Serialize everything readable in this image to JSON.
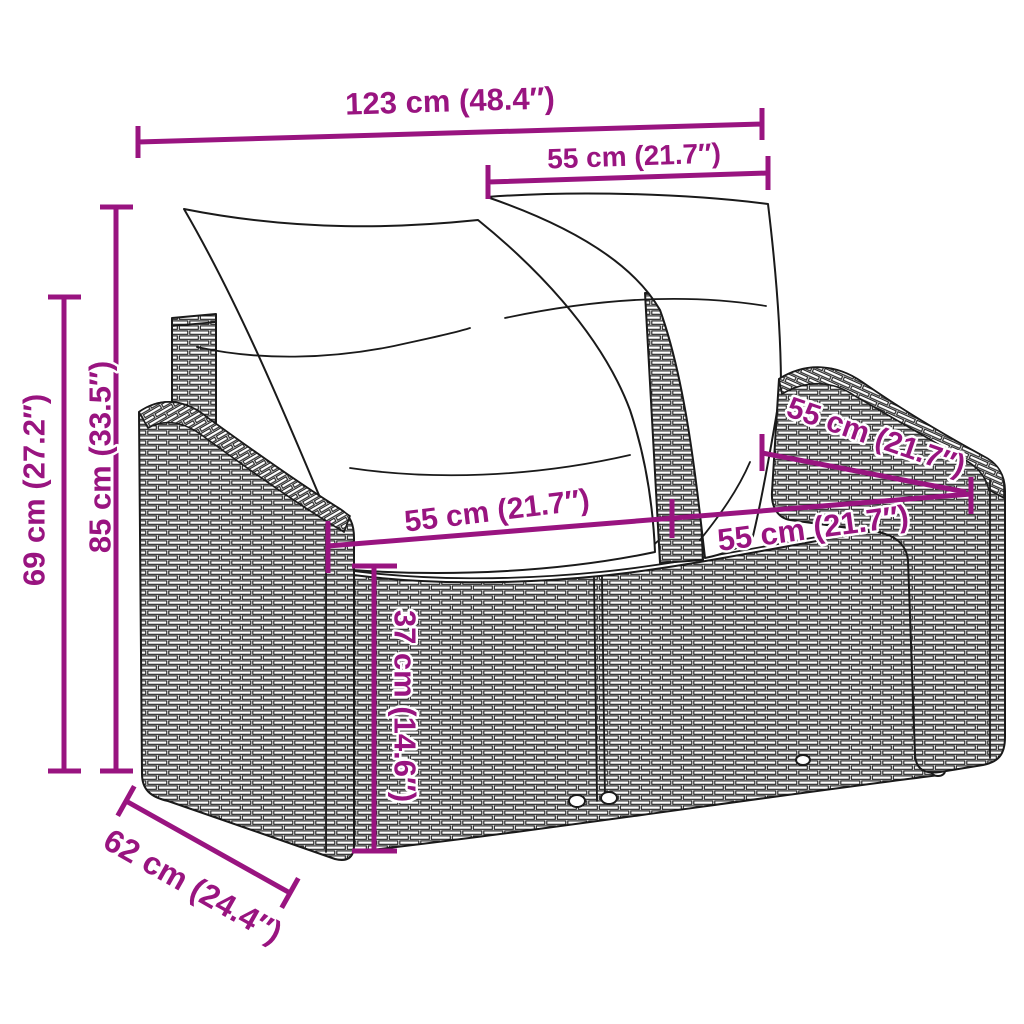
{
  "page": {
    "background": "#ffffff",
    "illustration": "line drawing of a 2-seater poly rattan garden sofa with two back pillows and two seat cushions"
  },
  "colors": {
    "dimension": "#991480",
    "line_art": "#1a1a1a"
  },
  "dimensions": {
    "total_width": "123 cm (48.4″)",
    "back_cushion_width": "55 cm (21.7″)",
    "total_height": "85 cm (33.5″)",
    "armrest_height": "69 cm (27.2″)",
    "seat_width_left": "55 cm (21.7″)",
    "seat_width_right": "55 cm (21.7″)",
    "seat_depth": "55 cm (21.7″)",
    "seat_height": "37 cm (14.6″)",
    "total_depth": "62 cm (24.4″)"
  }
}
